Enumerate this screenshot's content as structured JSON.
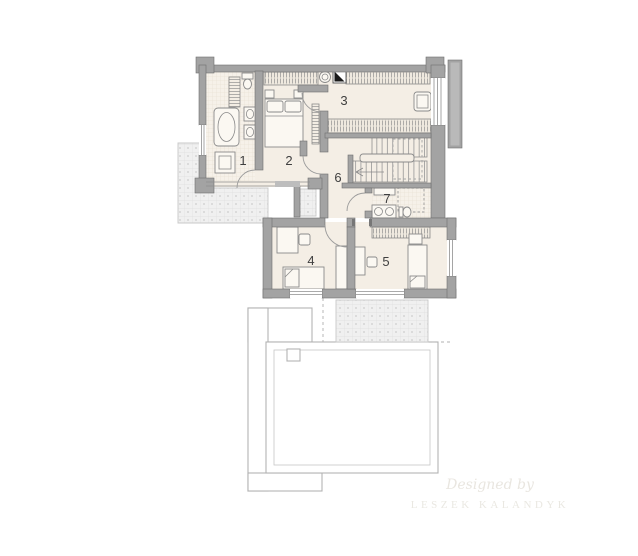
{
  "title": "floor-plan",
  "plan": {
    "rooms": [
      {
        "number": "1"
      },
      {
        "number": "2"
      },
      {
        "number": "3"
      },
      {
        "number": "4"
      },
      {
        "number": "5"
      },
      {
        "number": "6"
      },
      {
        "number": "7"
      }
    ]
  },
  "watermark": {
    "line1": "Designed by",
    "line2": "LESZEK KALANDYK"
  },
  "colors": {
    "background": "#ffffff",
    "wall": "#a3a3a3",
    "floor": "#f4eee5",
    "terrace": "#f0f0f0",
    "label": "#3f3f3f",
    "watermark": "#e9e6e0",
    "black_marker": "#1a1a1a"
  }
}
